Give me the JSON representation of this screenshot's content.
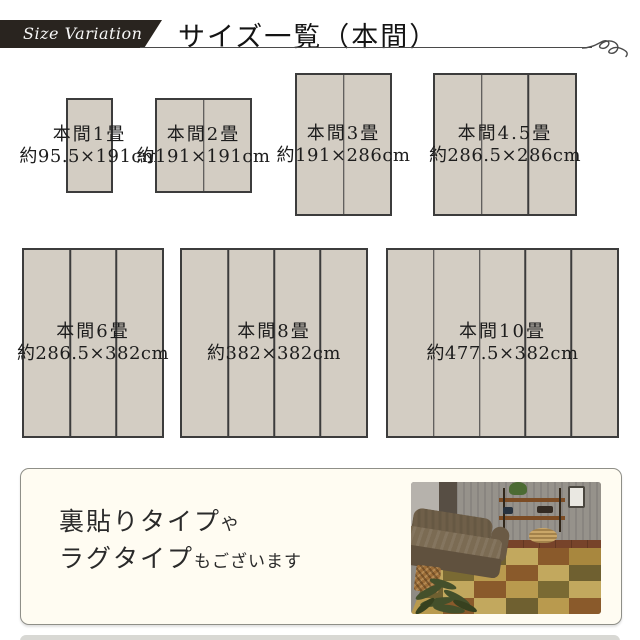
{
  "header": {
    "ribbon_label": "Size Variation",
    "title": "サイズ一覧（本間）",
    "colors": {
      "ribbon_bg": "#29241f",
      "ribbon_text": "#f7f7f7",
      "title_text": "#141414",
      "rule": "#4a4a4a"
    },
    "icons": {
      "flourish": "calligraphic-swirl"
    }
  },
  "mats": {
    "fill": "#d3cdc3",
    "border": "#3c3c3c",
    "items": [
      {
        "name": "本間1畳",
        "size": "約95.5×191cm",
        "panels": 1,
        "px": {
          "x": 66,
          "y": 98,
          "w": 47,
          "h": 95
        }
      },
      {
        "name": "本間2畳",
        "size": "約191×191cm",
        "panels": 2,
        "px": {
          "x": 155,
          "y": 98,
          "w": 97,
          "h": 95
        }
      },
      {
        "name": "本間3畳",
        "size": "約191×286cm",
        "panels": 2,
        "px": {
          "x": 295,
          "y": 73,
          "w": 97,
          "h": 143
        }
      },
      {
        "name": "本間4.5畳",
        "size": "約286.5×286cm",
        "panels": 3,
        "px": {
          "x": 433,
          "y": 73,
          "w": 144,
          "h": 143
        }
      },
      {
        "name": "本間6畳",
        "size": "約286.5×382cm",
        "panels": 3,
        "px": {
          "x": 22,
          "y": 248,
          "w": 142,
          "h": 190
        }
      },
      {
        "name": "本間8畳",
        "size": "約382×382cm",
        "panels": 4,
        "px": {
          "x": 180,
          "y": 248,
          "w": 188,
          "h": 190
        }
      },
      {
        "name": "本間10畳",
        "size": "約477.5×382cm",
        "panels": 5,
        "px": {
          "x": 386,
          "y": 248,
          "w": 233,
          "h": 190
        }
      }
    ]
  },
  "footer": {
    "line1_main": "裏貼りタイプ",
    "line1_sub": "や",
    "line2_main": "ラグタイプ",
    "line2_sub": "もございます",
    "box_bg": "#fffcf2",
    "box_border": "#8f8f88"
  },
  "photo": {
    "description": "living-room-with-patchwork-tatami-rug",
    "colors": {
      "wall": "#96928b",
      "wall_left": "#b6b2ac",
      "floor": "#77432a",
      "sofa": "#6f5f49",
      "plant": "#44502b",
      "basket": "#caa768"
    },
    "rug_rows": [
      [
        "#8a5a2b",
        "#b99a4e",
        "#6f6030",
        "#c2a85e",
        "#8a5a2b",
        "#a8873e"
      ],
      [
        "#c2a85e",
        "#7a6a33",
        "#b99a4e",
        "#8a5a2b",
        "#c2a85e",
        "#6f6030"
      ],
      [
        "#6f6030",
        "#c2a85e",
        "#8a5a2b",
        "#b99a4e",
        "#7a6a33",
        "#c2a85e"
      ],
      [
        "#b99a4e",
        "#8a5a2b",
        "#c2a85e",
        "#6f6030",
        "#b99a4e",
        "#8a5a2b"
      ]
    ],
    "rug_patterns": [
      [
        "plain",
        "dots",
        "stripes",
        "plain",
        "stripes",
        "plain"
      ],
      [
        "stripes",
        "plain",
        "dots",
        "plain",
        "dots",
        "stripes"
      ],
      [
        "dots",
        "stripes",
        "plain",
        "stripes",
        "plain",
        "dots"
      ],
      [
        "plain",
        "stripes",
        "dots",
        "plain",
        "stripes",
        "plain"
      ]
    ]
  },
  "misc": {
    "bottom_band_color": "#d8d8d4"
  }
}
